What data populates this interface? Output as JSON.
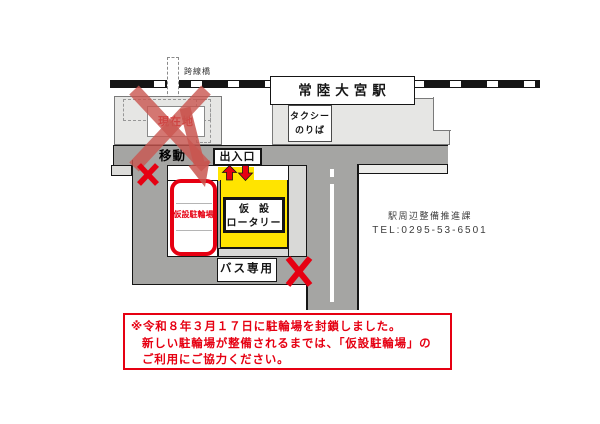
{
  "map": {
    "station_name": "常陸大宮駅",
    "bridge_label": "跨線橋",
    "current_location_label": "現在地",
    "move_label": "移動",
    "entrance_label": "出入口",
    "taxi_stand": {
      "line1": "タクシー",
      "line2": "のりば"
    },
    "temp_bike_parking_label": "仮設駐輪場",
    "temp_rotary": {
      "line1": "仮　設",
      "line2": "ロータリー"
    },
    "bus_only_label": "バス専用"
  },
  "contact": {
    "department": "駅周辺整備推進課",
    "tel": "TEL:0295-53-6501"
  },
  "notice": {
    "line1": "※令和８年３月１７日に駐輪場を封鎖しました。",
    "line2": "新しい駐輪場が整備されるまでは、「仮設駐輪場」の",
    "line3": "ご利用にご協力ください。"
  },
  "colors": {
    "accent_red": "#e60012",
    "soft_red": "#c9554f",
    "yellow": "#ffe400",
    "road_gray": "#a5a5a3",
    "plaza_gray": "#e6e6e4",
    "light_gray": "#d9d9d7"
  }
}
